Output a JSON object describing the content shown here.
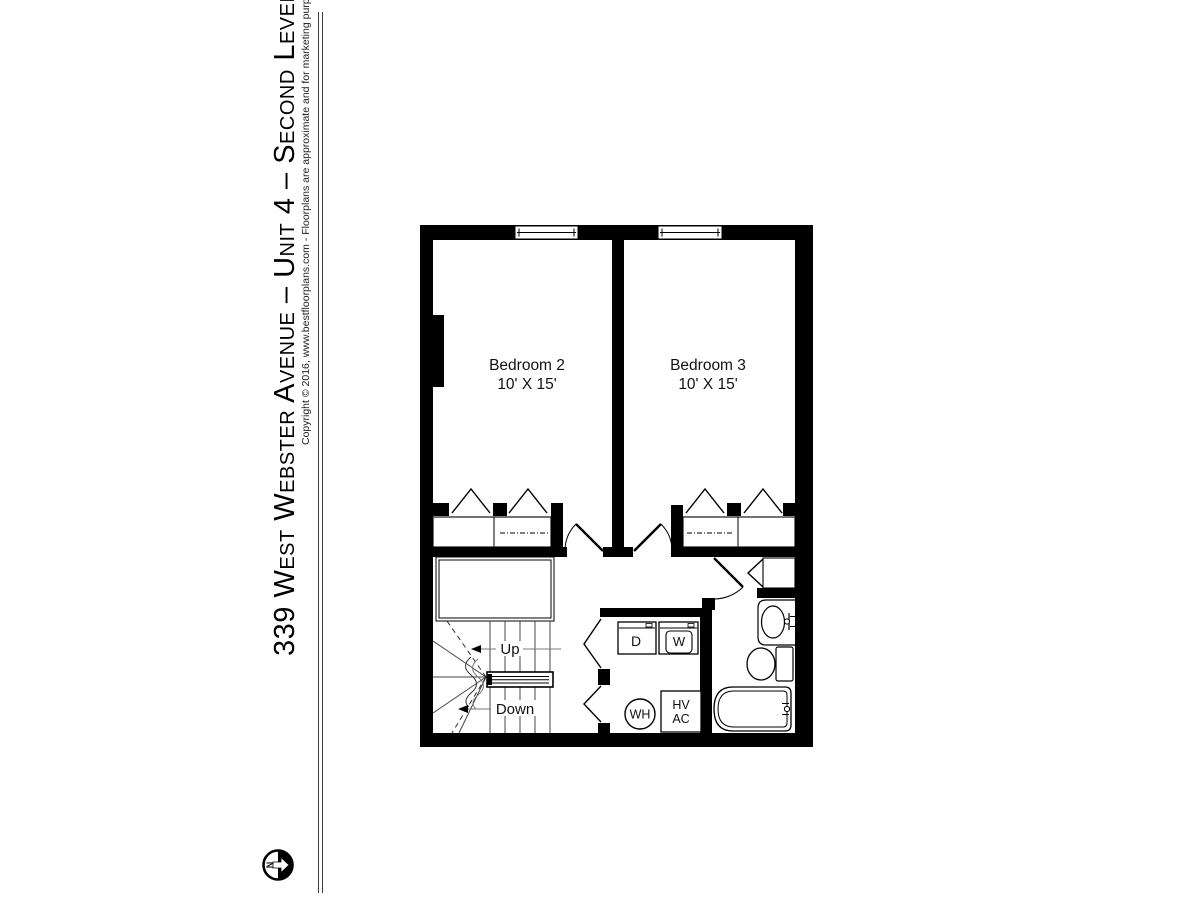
{
  "sidebar": {
    "title": "339 West Webster Avenue – Unit 4 – Second Level",
    "copyright": "Copyright © 2016, www.bestfloorplans.com - Floorplans are approximate and for marketing purposes only",
    "compass_label": "N"
  },
  "plan": {
    "rooms": [
      {
        "name": "Bedroom 2",
        "dimensions": "10' X 15'"
      },
      {
        "name": "Bedroom 3",
        "dimensions": "10' X 15'"
      }
    ],
    "stairs": {
      "up_label": "Up",
      "down_label": "Down"
    },
    "fixtures": {
      "dryer": "D",
      "washer": "W",
      "water_heater": "WH",
      "hvac_line1": "HV",
      "hvac_line2": "AC"
    },
    "colors": {
      "wall": "#000000",
      "thin_line": "#333333"
    }
  }
}
